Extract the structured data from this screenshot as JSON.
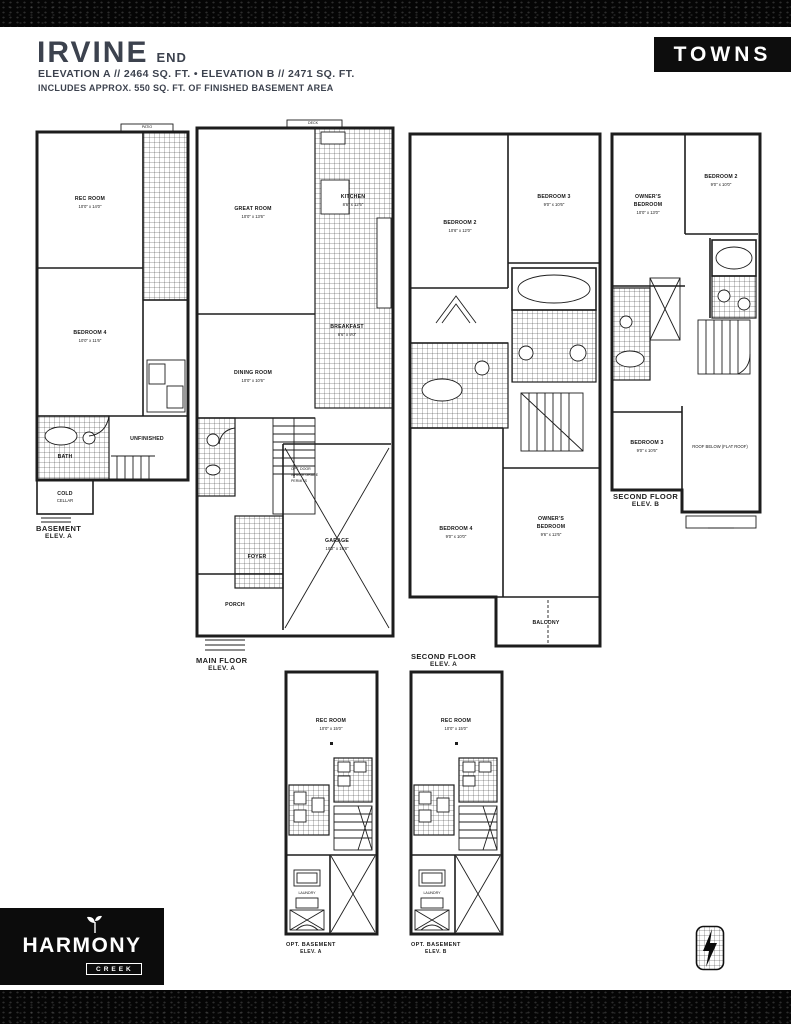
{
  "header": {
    "title": "IRVINE",
    "unit_type": "END",
    "badge": "TOWNS",
    "elevation_line": "ELEVATION A  //  2464 SQ. FT.   •   ELEVATION B  //  2471 SQ. FT.",
    "basement_line": "INCLUDES APPROX. 550 SQ. FT. OF FINISHED BASEMENT AREA"
  },
  "plans": {
    "basement": {
      "caption1": "BASEMENT",
      "caption2": "ELEV. A",
      "outdoor": "PATIO",
      "rooms": {
        "rec": {
          "l1": "REC ROOM",
          "l2": "10'0\" x 14'0\""
        },
        "bed4": {
          "l1": "BEDROOM 4",
          "l2": "10'0\" x 11'6\""
        },
        "bath": {
          "l1": "BATH"
        },
        "unf": {
          "l1": "UNFINISHED"
        },
        "cold": {
          "l1": "COLD",
          "l2": "CELLAR"
        }
      }
    },
    "main": {
      "caption1": "MAIN FLOOR",
      "caption2": "ELEV. A",
      "outdoor": "DECK",
      "rooms": {
        "great": {
          "l1": "GREAT ROOM",
          "l2": "10'0\" x 13'6\""
        },
        "kitchen": {
          "l1": "KITCHEN",
          "l2": "8'6\" x 12'6\""
        },
        "breakfast": {
          "l1": "BREAKFAST",
          "l2": "8'6\" x 9'0\""
        },
        "dining": {
          "l1": "DINING ROOM",
          "l2": "10'0\" x 10'6\""
        },
        "foyer": {
          "l1": "FOYER"
        },
        "garage": {
          "l1": "GARAGE",
          "l2": "10'2\" x 19'8\""
        },
        "note": {
          "l1": "OPT. DOOR",
          "l2": "WHERE GRADE",
          "l3": "PERMITS"
        },
        "porch": {
          "l1": "PORCH"
        }
      }
    },
    "second_a": {
      "caption1": "SECOND FLOOR",
      "caption2": "ELEV. A",
      "rooms": {
        "bed2": {
          "l1": "BEDROOM 2",
          "l2": "10'6\" x 12'0\""
        },
        "bed3": {
          "l1": "BEDROOM 3",
          "l2": "9'0\" x 10'6\""
        },
        "bed4": {
          "l1": "BEDROOM 4",
          "l2": "9'0\" x 10'0\""
        },
        "owners": {
          "l1": "OWNER'S",
          "l2": "BEDROOM",
          "l3": "9'6\" x 12'6\""
        },
        "balcony": {
          "l1": "BALCONY"
        }
      }
    },
    "second_b": {
      "caption1": "SECOND FLOOR",
      "caption2": "ELEV. B",
      "rooms": {
        "owners": {
          "l1": "OWNER'S",
          "l2": "BEDROOM",
          "l3": "10'0\" x 13'0\""
        },
        "bed2": {
          "l1": "BEDROOM 2",
          "l2": "9'0\" x 10'0\""
        },
        "bed3": {
          "l1": "BEDROOM 3",
          "l2": "9'0\" x 10'6\""
        },
        "roof": {
          "l1": "ROOF BELOW (FLAT ROOF)"
        }
      }
    },
    "basement_opt_a": {
      "caption1": "OPT. BASEMENT",
      "caption2": "ELEV. A",
      "rooms": {
        "rec": {
          "l1": "REC ROOM",
          "l2": "10'0\" x 15'0\""
        },
        "laundry": {
          "l1": "LAUNDRY"
        }
      }
    },
    "basement_opt_b": {
      "caption1": "OPT. BASEMENT",
      "caption2": "ELEV. B",
      "rooms": {
        "rec": {
          "l1": "REC ROOM",
          "l2": "10'0\" x 15'0\""
        },
        "laundry": {
          "l1": "LAUNDRY"
        }
      }
    }
  },
  "footer": {
    "brand": "HARMONY",
    "brand_sub": "CREEK"
  },
  "colors": {
    "heading": "#3c424e",
    "ink": "#1d1d1d",
    "bar": "#050505"
  }
}
